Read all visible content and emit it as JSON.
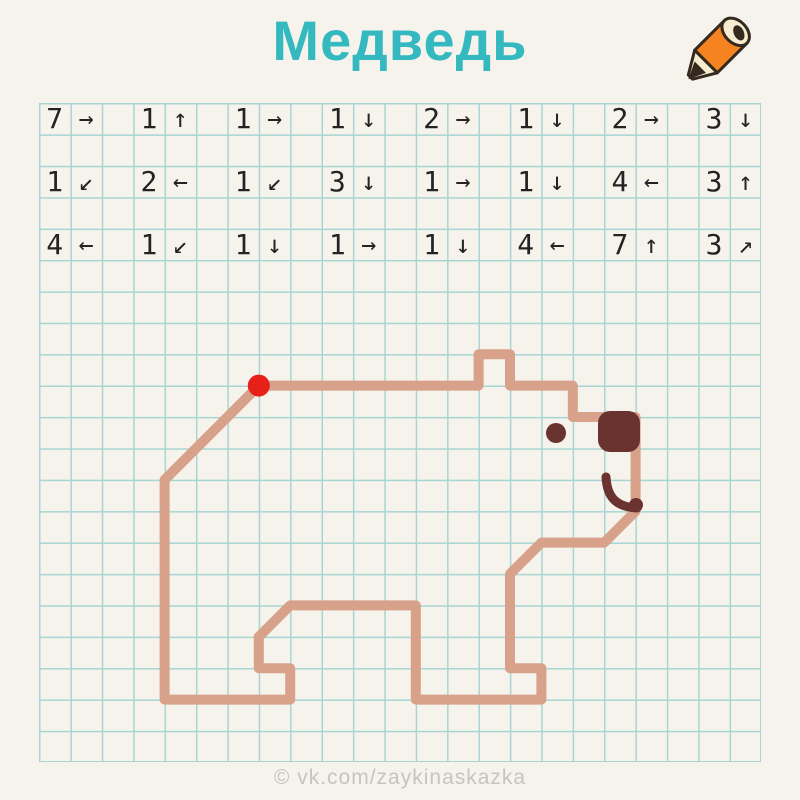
{
  "title": "Медведь",
  "watermark": "© vk.com/zaykinaskazka",
  "theme": {
    "paper": "#f5f3ec",
    "grid_line": "#a8d5d3",
    "title_color": "#35b9c0",
    "ink": "#232323",
    "bear_outline": "#d8a189",
    "bear_dark": "#6b332f",
    "start_dot": "#e8201a",
    "watermark_color": "#c6c4bd",
    "pencil_orange": "#f5831f",
    "pencil_cream": "#f8eccf",
    "pencil_dark": "#33291f"
  },
  "grid": {
    "origin_x": 39,
    "origin_y": 103,
    "cell": 31.4,
    "cols": 23,
    "rows": 21
  },
  "instructions": {
    "grid_rows": [
      0,
      2,
      4
    ],
    "pair_col_step": 3,
    "rows": [
      [
        {
          "n": "7",
          "a": "→"
        },
        {
          "n": "1",
          "a": "↑"
        },
        {
          "n": "1",
          "a": "→"
        },
        {
          "n": "1",
          "a": "↓"
        },
        {
          "n": "2",
          "a": "→"
        },
        {
          "n": "1",
          "a": "↓"
        },
        {
          "n": "2",
          "a": "→"
        },
        {
          "n": "3",
          "a": "↓"
        }
      ],
      [
        {
          "n": "1",
          "a": "↙"
        },
        {
          "n": "2",
          "a": "←"
        },
        {
          "n": "1",
          "a": "↙"
        },
        {
          "n": "3",
          "a": "↓"
        },
        {
          "n": "1",
          "a": "→"
        },
        {
          "n": "1",
          "a": "↓"
        },
        {
          "n": "4",
          "a": "←"
        },
        {
          "n": "3",
          "a": "↑"
        }
      ],
      [
        {
          "n": "4",
          "a": "←"
        },
        {
          "n": "1",
          "a": "↙"
        },
        {
          "n": "1",
          "a": "↓"
        },
        {
          "n": "1",
          "a": "→"
        },
        {
          "n": "1",
          "a": "↓"
        },
        {
          "n": "4",
          "a": "←"
        },
        {
          "n": "7",
          "a": "↑"
        },
        {
          "n": "3",
          "a": "↗"
        }
      ]
    ]
  },
  "bear": {
    "outline_points": "258.8,385.6 478.6,385.6 478.6,354.2 510,354.2 510,385.6 572.8,385.6 572.8,417 635.6,417 635.6,511.2 604.2,542.6 541.4,542.6 510,574 510,668.2 541.4,668.2 541.4,699.6 415.8,699.6 415.8,605.4 290.2,605.4 258.8,636.8 258.8,668.2 290.2,668.2 290.2,699.6 164.6,699.6 164.6,479.8",
    "nose": {
      "x": "598",
      "y": "411",
      "width": "42",
      "height": "41",
      "rx": "12"
    },
    "eye": {
      "cx": "556",
      "cy": "433",
      "r": "10"
    },
    "mouth_d": "M 606 477 C 607 497 616 507 637 508",
    "mouth_end": {
      "cx": "636",
      "cy": "505",
      "r": "7"
    },
    "start_dot": {
      "cx": "258.8",
      "cy": "385.6",
      "r": "11"
    }
  }
}
